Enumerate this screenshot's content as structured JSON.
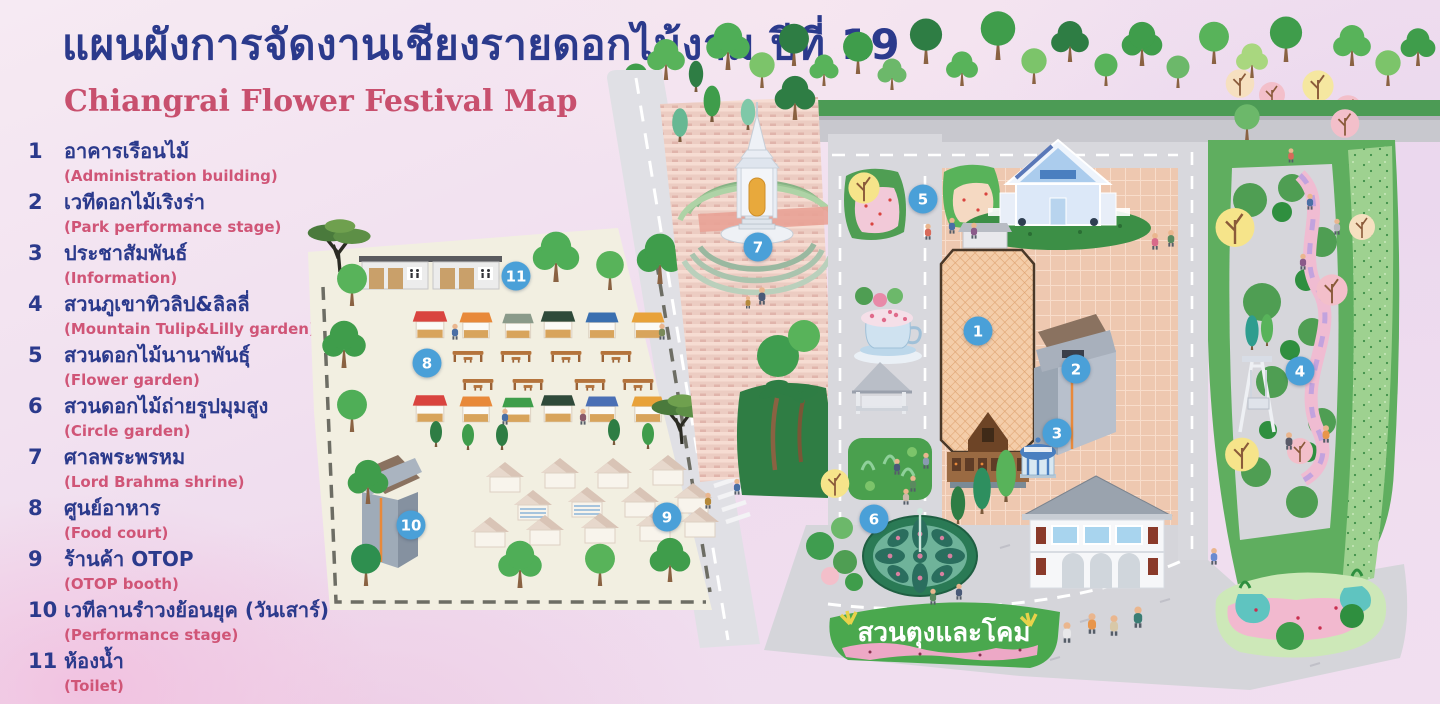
{
  "title": {
    "thai": "แผนผังการจัดงานเชียงรายดอกไม้งาม ปีที่ 19",
    "english": "Chiangrai Flower Festival Map"
  },
  "legend": {
    "items": [
      {
        "num": "1",
        "thai": "อาคารเรือนไม้",
        "english": "(Administration building)"
      },
      {
        "num": "2",
        "thai": "เวทีดอกไม้เริงร่า",
        "english": "(Park performance stage)"
      },
      {
        "num": "3",
        "thai": "ประชาสัมพันธ์",
        "english": "(Information)"
      },
      {
        "num": "4",
        "thai": "สวนภูเขาทิวลิป&ลิลลี่",
        "english": "(Mountain Tulip&Lilly garden)"
      },
      {
        "num": "5",
        "thai": "สวนดอกไม้นานาพันธุ์",
        "english": "(Flower garden)"
      },
      {
        "num": "6",
        "thai": "สวนดอกไม้ถ่ายรูปมุมสูง",
        "english": "(Circle garden)"
      },
      {
        "num": "7",
        "thai": "ศาลพระพรหม",
        "english": "(Lord Brahma shrine)"
      },
      {
        "num": "8",
        "thai": "ศูนย์อาหาร",
        "english": "(Food court)"
      },
      {
        "num": "9",
        "thai": "ร้านค้า OTOP",
        "english": "(OTOP booth)"
      },
      {
        "num": "10",
        "thai": "เวทีลานรำวงย้อนยุค (วันเสาร์)",
        "english": "(Performance stage)"
      },
      {
        "num": "11",
        "thai": "ห้องน้ำ",
        "english": "(Toilet)"
      }
    ]
  },
  "map": {
    "garden_label": "สวนตุงและโคม",
    "markers": [
      {
        "num": "1"
      },
      {
        "num": "2"
      },
      {
        "num": "3"
      },
      {
        "num": "4"
      },
      {
        "num": "5"
      },
      {
        "num": "6"
      },
      {
        "num": "7"
      },
      {
        "num": "8"
      },
      {
        "num": "9"
      },
      {
        "num": "10"
      },
      {
        "num": "11"
      }
    ]
  },
  "colors": {
    "title_navy": "#2b3a8c",
    "subtitle_rose": "#c8506e",
    "legend_pink": "#d05577",
    "marker_blue": "#4aa0d8",
    "food_court_cream": "#f2efe1",
    "plaza_brick": "#eec8b0",
    "road_gray": "#d8d8dd",
    "garden_green": "#5fae5f"
  }
}
